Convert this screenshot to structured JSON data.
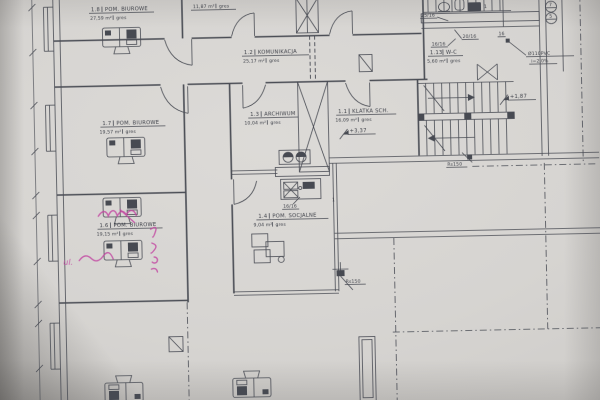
{
  "document": {
    "type": "architectural floor plan photo"
  },
  "rooms": [
    {
      "num": "1.8",
      "name": "POM. BIUROWE",
      "area": "27,59 m²",
      "finish": "gres"
    },
    {
      "num": "1.2",
      "name": "KOMUNIKACJA",
      "area": "25,17 m²",
      "finish": "gres"
    },
    {
      "num": "1.3",
      "name": "ARCHIWUM",
      "area": "10,04 m²",
      "finish": "gres"
    },
    {
      "num": "1.1",
      "name": "KLATKA SCH.",
      "area": "16,09 m²",
      "finish": "gres"
    },
    {
      "num": "1.7",
      "name": "POM. BIUROWE",
      "area": "19,57 m²",
      "finish": "gres"
    },
    {
      "num": "1.6",
      "name": "POM. BIUROWE",
      "area": "19,15 m²",
      "finish": "gres"
    },
    {
      "num": "1.4",
      "name": "POM. SOCJALNE",
      "area": "9,04 m²",
      "finish": "gres"
    },
    {
      "num": "1.13",
      "name": "W-C",
      "area": "5,60 m²",
      "finish": "gres"
    },
    {
      "num": "",
      "name": "",
      "area": "11,87 m²",
      "finish": "gres"
    }
  ],
  "levels": {
    "floor": "+3,37",
    "stair_mid": "+1,87"
  },
  "radiators": {
    "r1": "25/16",
    "r2": "20/16",
    "r3": "16",
    "r4": "16/16",
    "r5": "16/16"
  },
  "plumbing": {
    "pipe": "Ø110PVC",
    "slope": "i=2,0%",
    "downpipe_right": "Rs150",
    "downpipe_center": "Rs150"
  },
  "callouts": {
    "top": "7",
    "bottom": "5",
    "note_a": "1",
    "note_b": "1"
  },
  "handwriting": {
    "word": "ul."
  }
}
